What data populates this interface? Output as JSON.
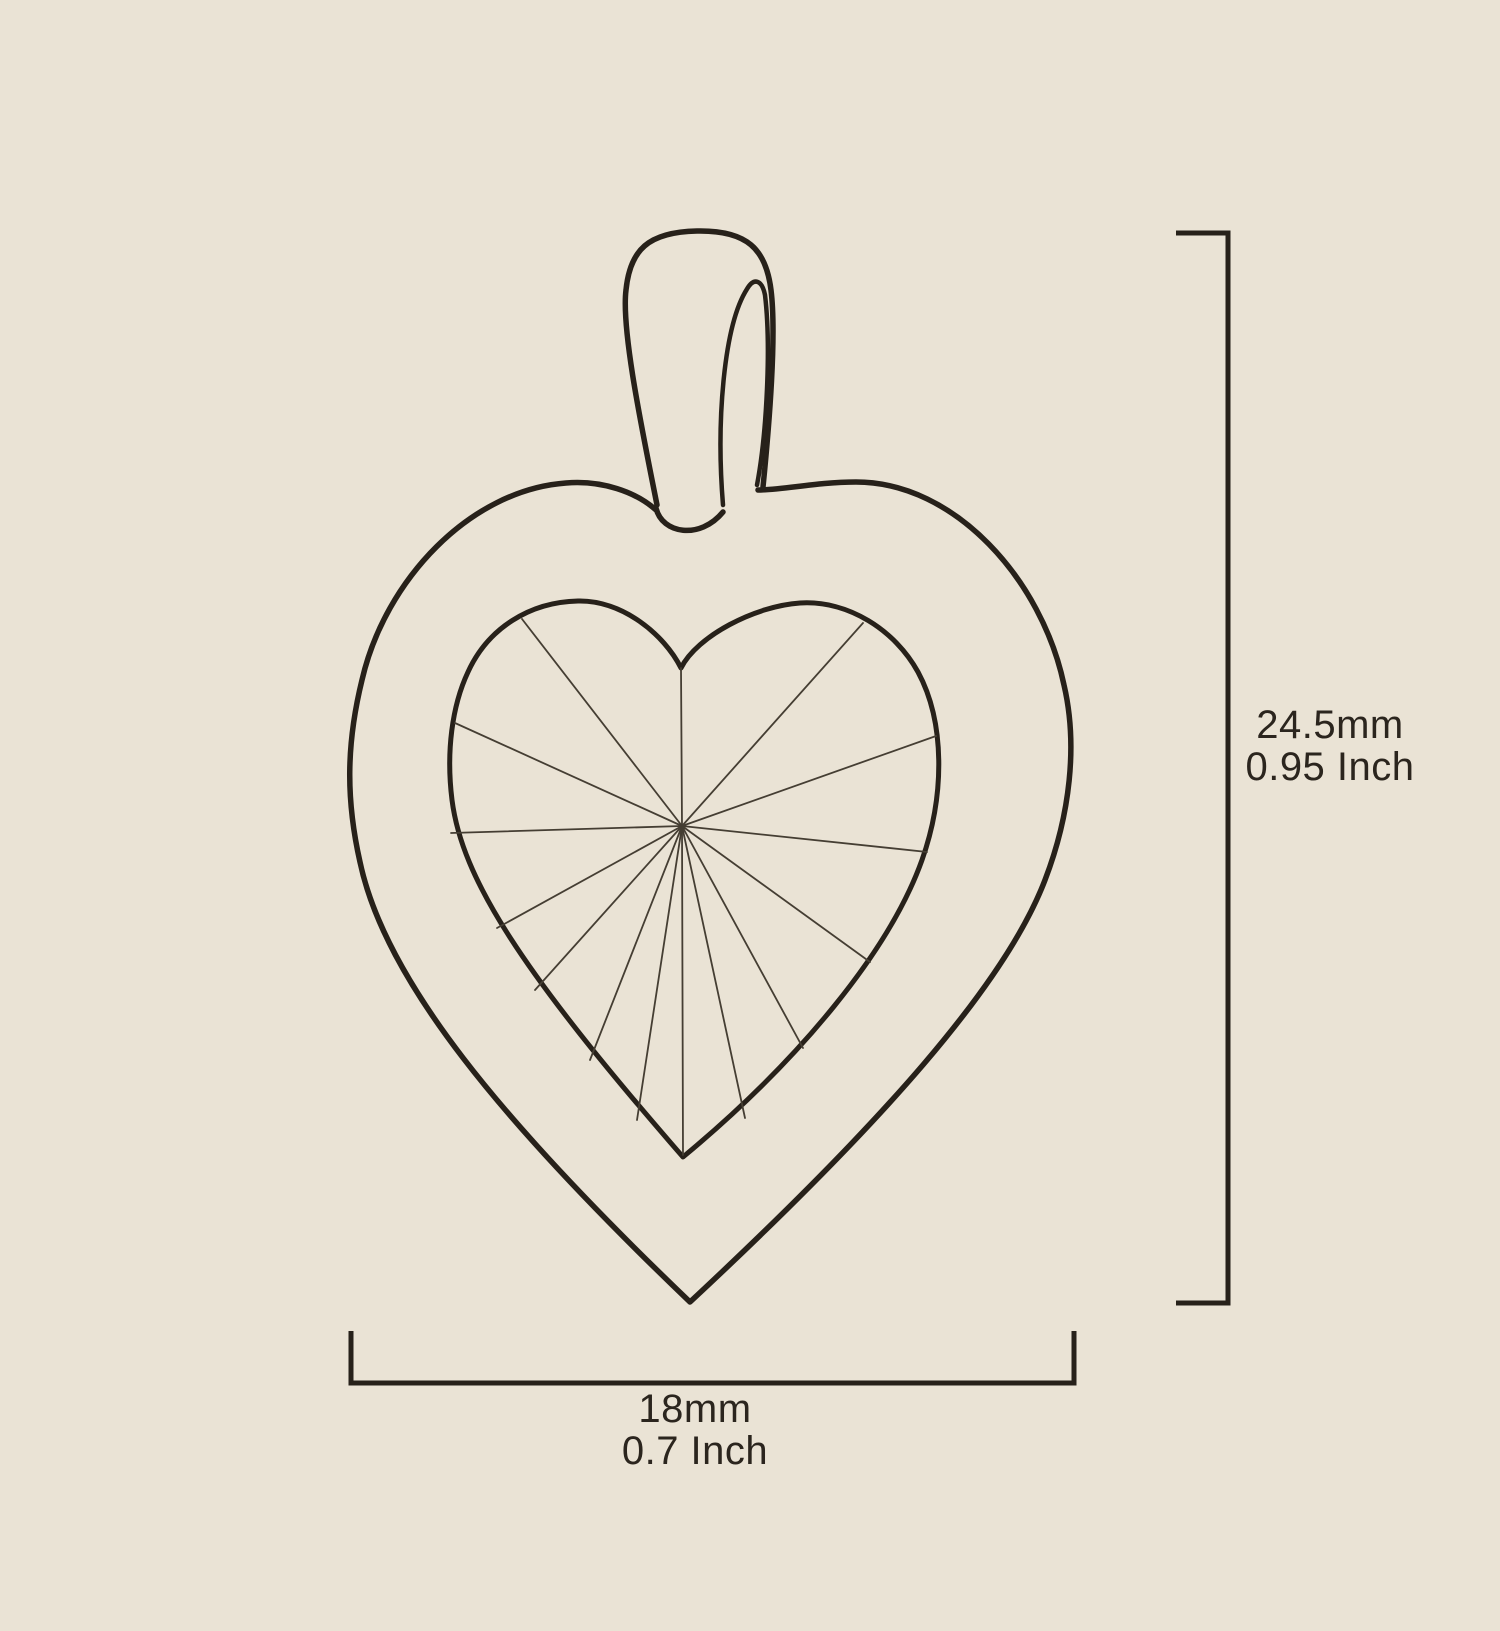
{
  "diagram": {
    "title": "Heart pendant size diagram",
    "subject": "Line drawing of a heart-shaped pendant with bail and faceted heart gemstone, annotated with height and width dimensions",
    "colors": {
      "background": "#EAE3D5",
      "line": "#27211A",
      "facet_line": "#453E33",
      "text": "#2B251E"
    },
    "height": {
      "mm": "24.5mm",
      "inch": "0.95 Inch"
    },
    "width": {
      "mm": "18mm",
      "inch": "0.7 Inch"
    }
  }
}
